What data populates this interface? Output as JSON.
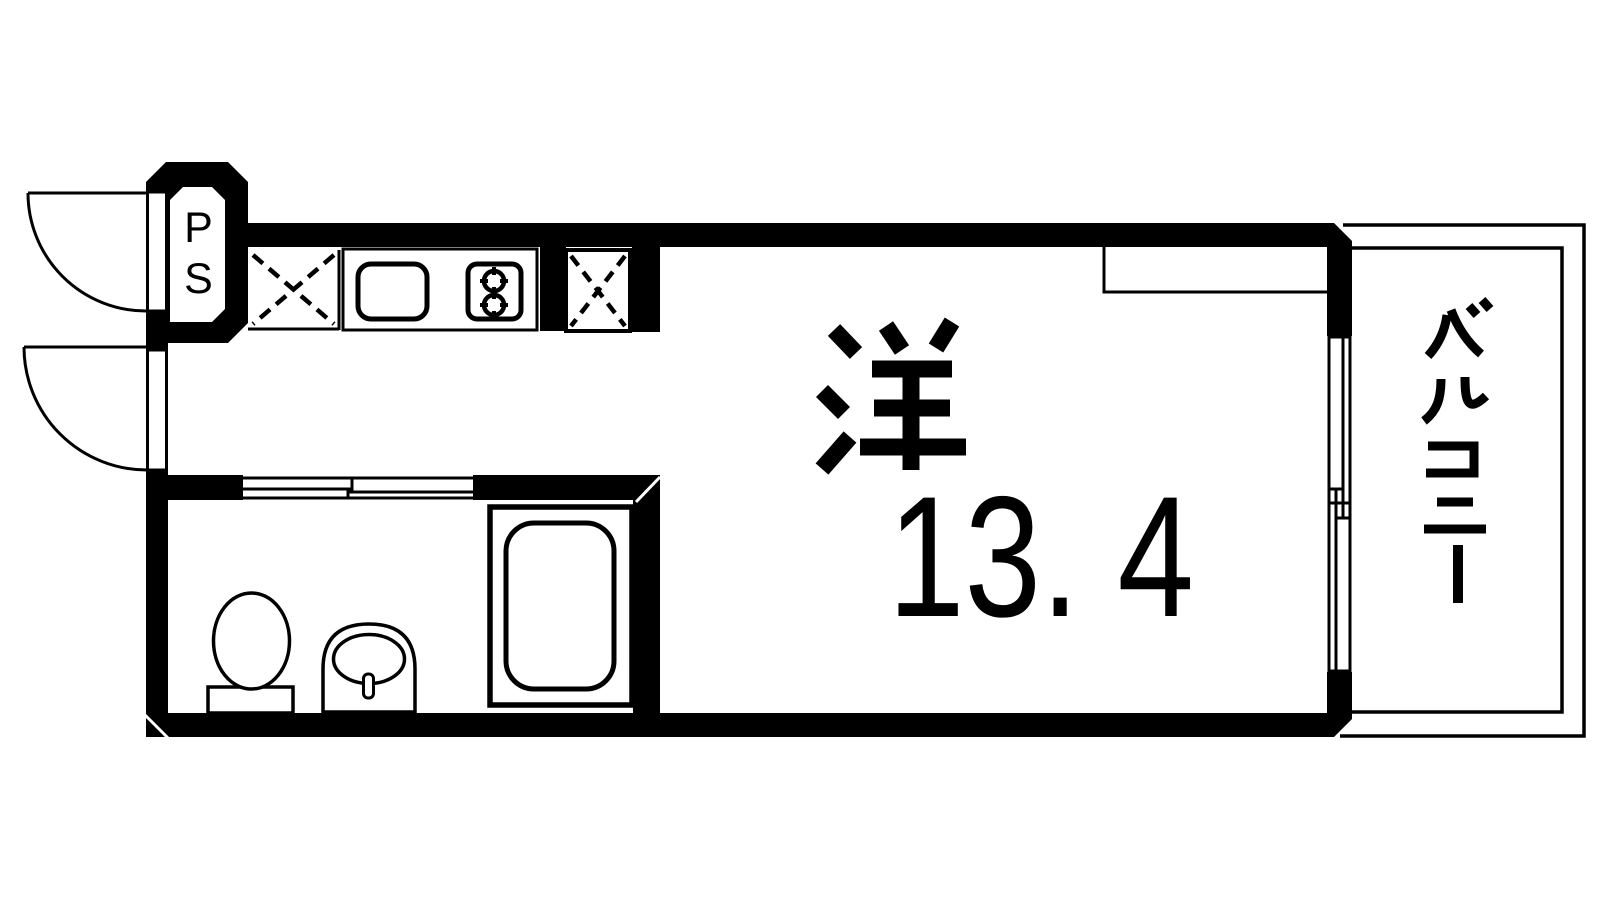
{
  "floorplan": {
    "room": {
      "label": "洋",
      "area": "13. 4"
    },
    "pipe_space": {
      "label": "PS"
    },
    "balcony": {
      "label": "バルコニー"
    },
    "colors": {
      "wall": "#000000",
      "line": "#000000",
      "background": "#ffffff"
    },
    "fixtures": [
      "entrance-door",
      "second-swing-door",
      "pipe-space",
      "refrigerator-space",
      "kitchen-counter",
      "kitchen-sink",
      "gas-stove-2-burner",
      "storage-space",
      "sliding-door",
      "unit-bath",
      "toilet",
      "wash-basin",
      "bathtub",
      "closet-counter",
      "sliding-window",
      "balcony"
    ]
  }
}
